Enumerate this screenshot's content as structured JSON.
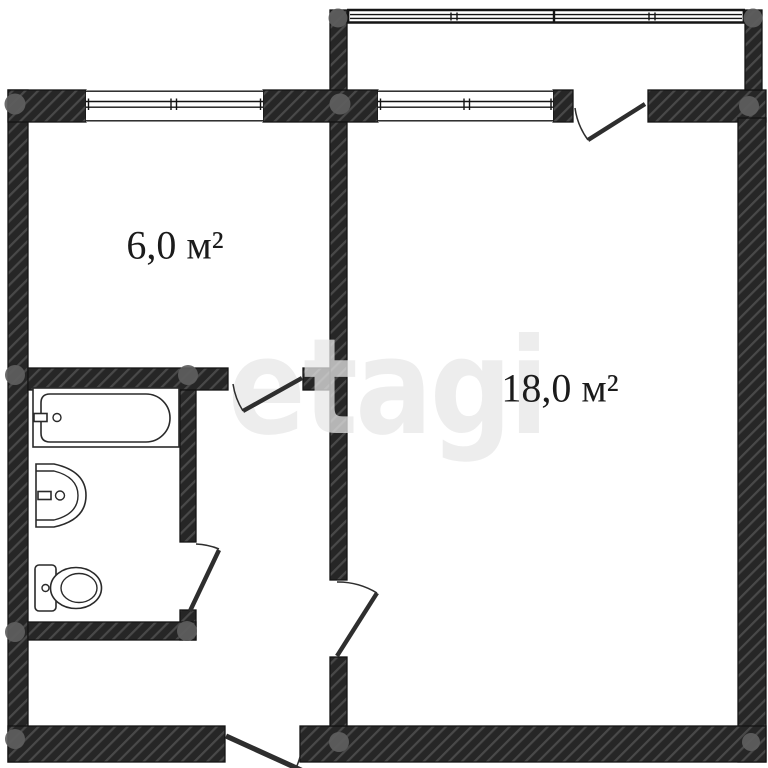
{
  "plan": {
    "watermark_text": "etagi",
    "rooms": {
      "kitchen": {
        "name": "kitchen",
        "area_label": "6,0 м²"
      },
      "living_room": {
        "name": "living room",
        "area_label": "18,0 м²"
      }
    },
    "fixtures": [
      "bathtub",
      "sink",
      "toilet"
    ],
    "features": [
      "balcony-glazing",
      "kitchen-window",
      "living-room-window",
      "balcony-door",
      "kitchen-door",
      "bathroom-door",
      "living-room-door",
      "entrance-door"
    ],
    "colors": {
      "background": "#ffffff",
      "wall": "#262626",
      "wall_stripe": "#7a7a7a",
      "line": "#141414",
      "fixture_line": "#2a2a2a",
      "door": "#2e2e2e",
      "dot": "#5e5e5e",
      "watermark": "#e7e7e7",
      "label": "#1b1b1b"
    }
  }
}
